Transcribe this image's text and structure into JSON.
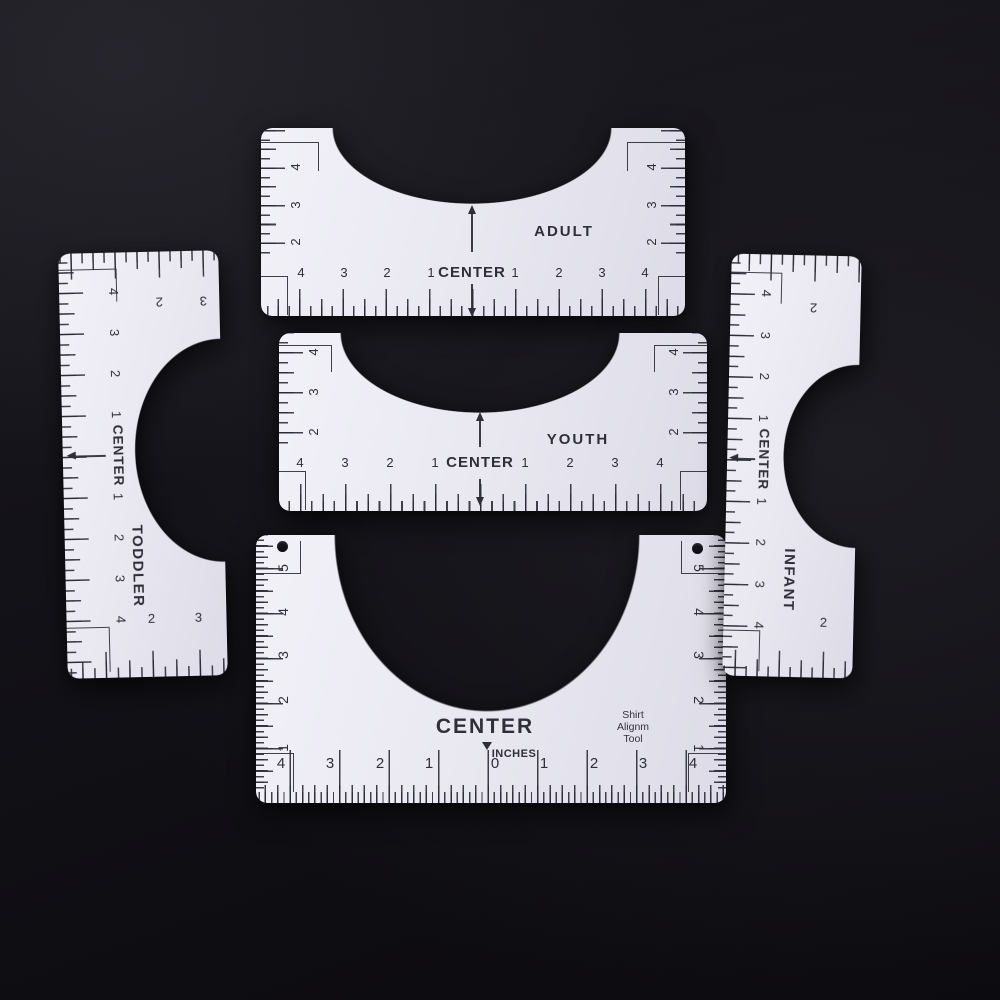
{
  "colors": {
    "background": "#131218",
    "ruler_body": "#e9e8f1",
    "ink": "#2f2f3a"
  },
  "rulers": {
    "adult": {
      "label": "ADULT",
      "center_label": "CENTER",
      "bottom_left": [
        "4",
        "3",
        "2",
        "1"
      ],
      "bottom_right": [
        "1",
        "2",
        "3",
        "4"
      ],
      "side_left": [
        "4",
        "3",
        "2"
      ],
      "side_right": [
        "4",
        "3",
        "2"
      ]
    },
    "youth": {
      "label": "YOUTH",
      "center_label": "CENTER",
      "bottom_left": [
        "4",
        "3",
        "2",
        "1"
      ],
      "bottom_right": [
        "1",
        "2",
        "3",
        "4"
      ],
      "side_left": [
        "4",
        "3",
        "2"
      ],
      "side_right": [
        "4",
        "3",
        "2"
      ]
    },
    "toddler": {
      "label": "TODDLER",
      "center_label": "CENTER",
      "scale_top": [
        "4",
        "3",
        "2",
        "1"
      ],
      "scale_bottom": [
        "1",
        "2",
        "3",
        "4"
      ],
      "cross_top": [
        "2",
        "3"
      ],
      "cross_bottom": [
        "2",
        "3"
      ]
    },
    "infant": {
      "label": "INFANT",
      "center_label": "CENTER",
      "scale_top": [
        "4",
        "3",
        "2",
        "1"
      ],
      "scale_bottom": [
        "1",
        "2",
        "3",
        "4"
      ],
      "cross_top": [
        "2"
      ],
      "cross_bottom": [
        "2"
      ]
    },
    "base": {
      "center_label": "CENTER",
      "units_label": "INCHES",
      "zero": "0",
      "brand_lines": [
        "Shirt",
        "Alignm",
        "Tool"
      ],
      "bottom_left": [
        "4",
        "3",
        "2",
        "1"
      ],
      "bottom_right": [
        "1",
        "2",
        "3",
        "4"
      ],
      "side_left": [
        "5",
        "4",
        "3",
        "2",
        "1"
      ],
      "side_right": [
        "5",
        "4",
        "3",
        "2",
        "1"
      ]
    }
  }
}
